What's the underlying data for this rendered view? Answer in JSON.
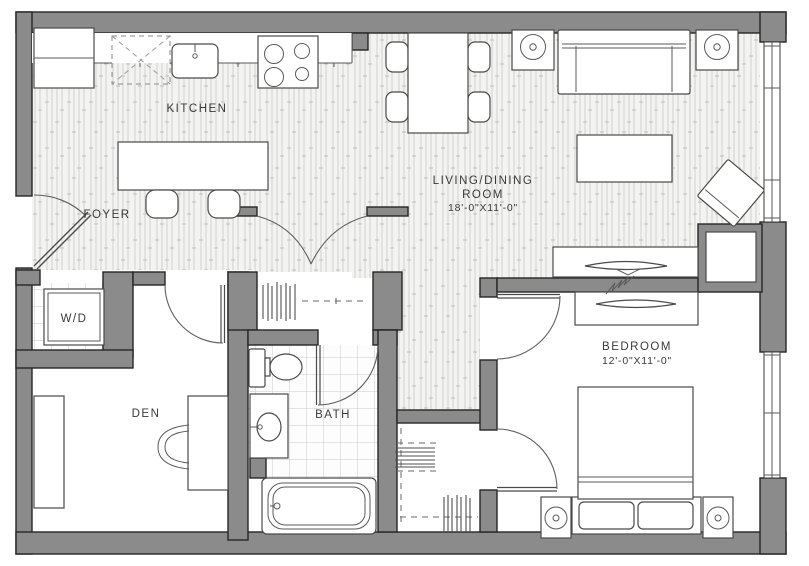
{
  "plan": {
    "name": "one-bedroom apartment floor plan",
    "colors": {
      "wall": "#8b8b8b",
      "wall_outline": "#262626",
      "furniture_line": "#4a4a4a",
      "floor_hatch": "#d2d2d0",
      "tile_line": "#c9c9c9",
      "label_text": "#3a3a3a",
      "background": "#ffffff"
    },
    "labels": {
      "kitchen": "KITCHEN",
      "foyer": "FOYER",
      "laundry": "W/D",
      "living_line1": "LIVING/DINING",
      "living_line2": "ROOM",
      "living_dims": "18'-0\"X11'-0\"",
      "den": "DEN",
      "bath": "BATH",
      "bedroom": "BEDROOM",
      "bedroom_dims": "12'-0\"X11'-0\""
    }
  }
}
